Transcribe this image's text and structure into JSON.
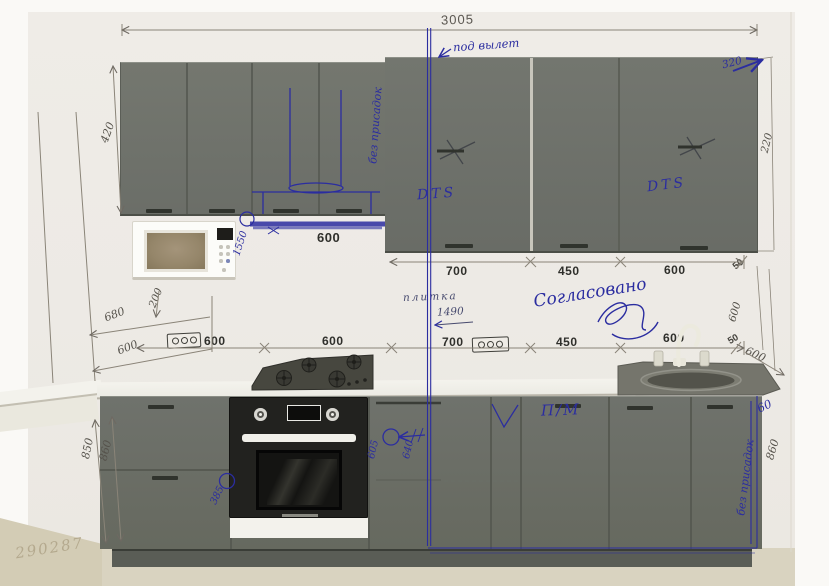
{
  "colors": {
    "pen_blue": "#2b2da0",
    "pencil_gray": "#8a8478",
    "print_black": "#2f2f2b",
    "cabinet_gray": "#6f726c",
    "floor_beige": "#d9d3c0"
  },
  "overall": {
    "total_width": "3005",
    "vent_note": "под вылет",
    "doc_number": "290287"
  },
  "upper_cabinets": {
    "left_height": "420",
    "no_dowels_note": "без присадок",
    "hood_width": "600",
    "microwave_height": "1550",
    "dts_left": "DTS",
    "dts_right": "DTS",
    "width_1": "700",
    "width_2": "450",
    "width_3": "600",
    "right_gap": "50",
    "top_depth": "320",
    "right_height": "220"
  },
  "backsplash": {
    "tile_label": "плитка",
    "tile_height": "1490",
    "approved_note": "Согласовано",
    "left_wall_depth": "680",
    "left_counter_depth": "600",
    "left_offset": "200",
    "width_1": "600",
    "width_2": "600",
    "width_3": "700",
    "width_4": "450",
    "width_5": "600",
    "right_gap": "50",
    "right_counter_depth": "600",
    "right_wall_height": "600"
  },
  "base_cabinets": {
    "left_height_a": "850",
    "left_height_b": "860",
    "oven_mark": "385",
    "mark_605": "605",
    "mark_640": "640",
    "dishwasher_label": "П/М",
    "no_dowels_note": "без присадок",
    "right_gap": "60",
    "right_height": "860"
  }
}
